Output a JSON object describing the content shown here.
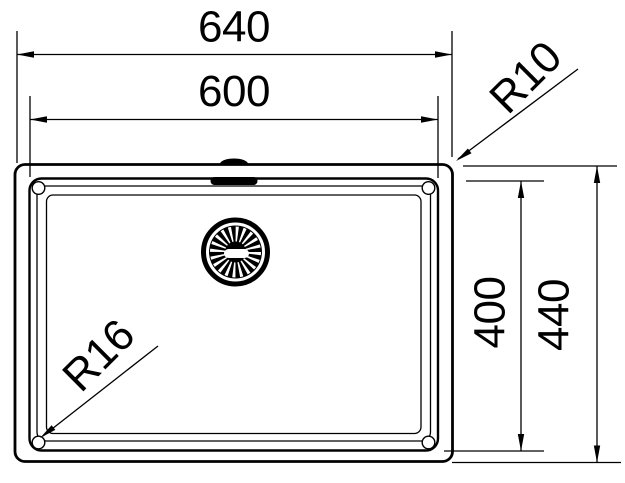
{
  "drawing": {
    "type": "technical-dimension-drawing",
    "colors": {
      "ink": "#000000",
      "background": "#ffffff"
    },
    "dimensions": [
      {
        "name": "outer-width",
        "label": "640",
        "orientation": "horizontal"
      },
      {
        "name": "bowl-width",
        "label": "600",
        "orientation": "horizontal"
      },
      {
        "name": "bowl-depth",
        "label": "400",
        "orientation": "vertical"
      },
      {
        "name": "outer-depth",
        "label": "440",
        "orientation": "vertical"
      },
      {
        "name": "outer-corner-radius",
        "label": "R10",
        "orientation": "diagonal-leader"
      },
      {
        "name": "bowl-corner-radius",
        "label": "R16",
        "orientation": "diagonal-leader"
      }
    ]
  }
}
